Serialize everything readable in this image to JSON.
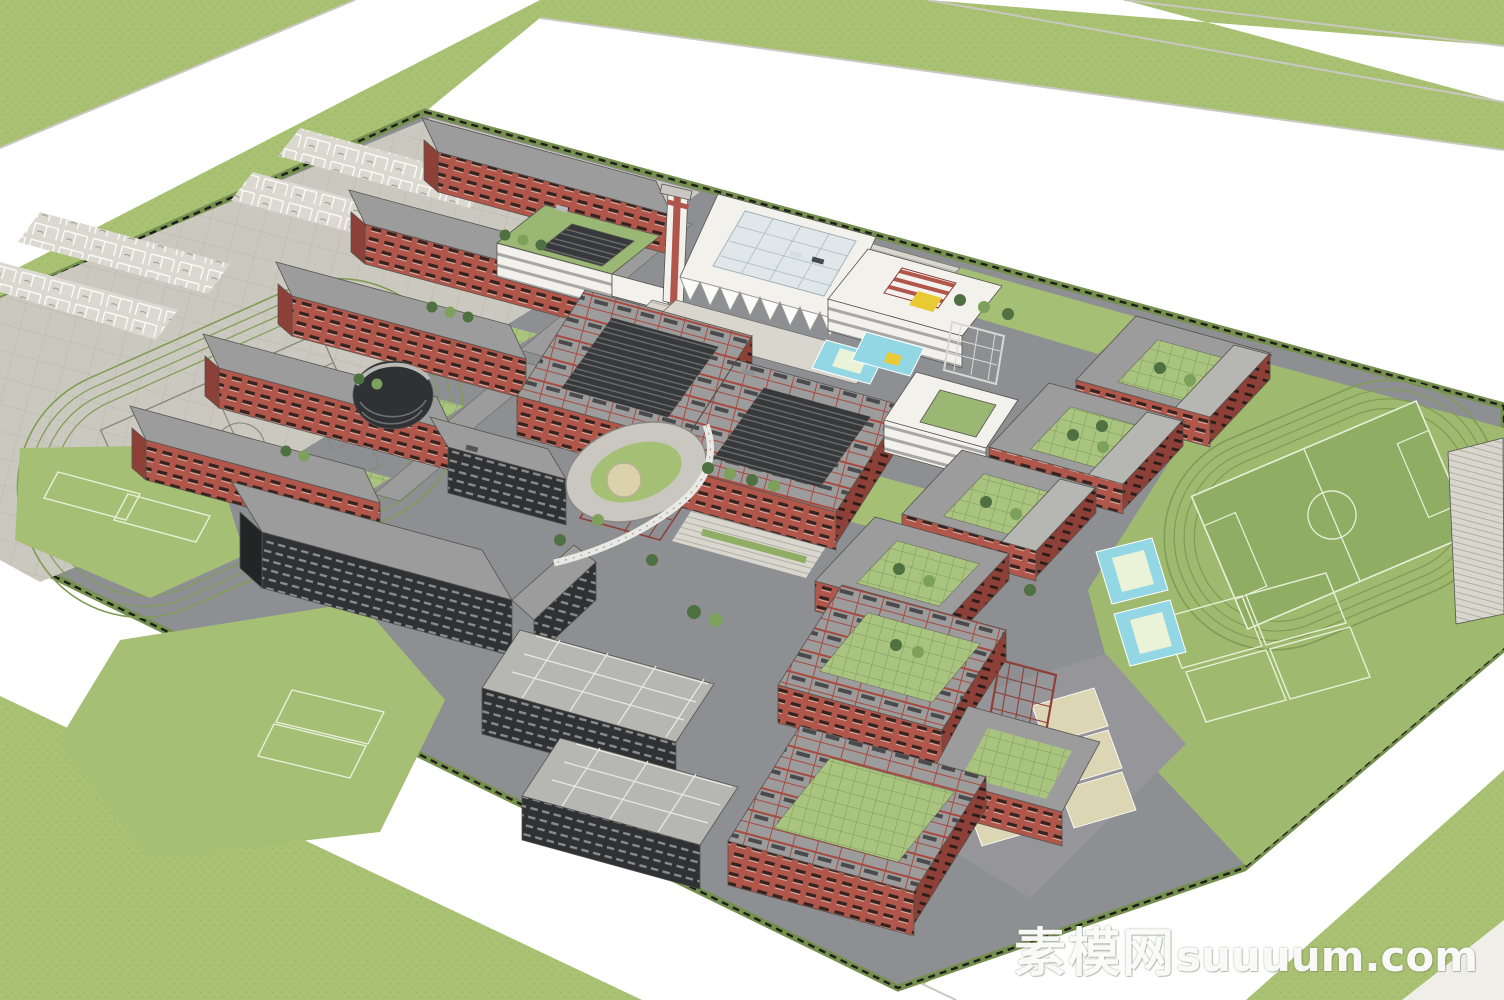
{
  "scene": {
    "type": "3d-campus-masterplan-render",
    "description": "Aerial axonometric SketchUp render of a university campus with red dormitory slabs, courtyard teaching buildings, white auditorium and library, clock tower, sports fields and surrounding roads"
  },
  "watermark": {
    "cn": "素模网",
    "en": "suuuum.com"
  },
  "colors": {
    "grass": "#a9c173",
    "grass_dark": "#9cb566",
    "road": "#ffffff",
    "road_edge": "#c9c8c0",
    "sidewalk": "#efeee9",
    "campus_asphalt": "#8e8f92",
    "pavement": "#cbc9bf",
    "pavement_light": "#dbd9cf",
    "pavement_line": "#96948a",
    "plaza": "#d8d6cd",
    "lawn": "#a5bf75",
    "sports_green": "#9fba6e",
    "field_green": "#8fae63",
    "field_line": "#e8efda",
    "track_line": "#7f9c55",
    "hedge": "#75904e",
    "fence": "#1d1d1b",
    "building_red": "#b0564a",
    "building_red_dark": "#8d4038",
    "window_dark": "#34231f",
    "roof_gray": "#9c9c9c",
    "roof_gray_light": "#b6b6b2",
    "dark_facade": "#303134",
    "dark_facade_hi": "#8a8b8d",
    "white_wall": "#f2f1ec",
    "white_band": "#a7a7a5",
    "green_roof": "#9ab873",
    "mesh_green": "#a9c47e",
    "mesh_line": "#7d985c",
    "court_cyan": "#93d7e4",
    "court_inner": "#eaf3d8",
    "tennis_tan": "#ddd6b4",
    "yellow": "#e9c934",
    "tree_green": "#4f7040",
    "tree_light": "#7da05b",
    "glass_blue": "#dfe7ea"
  }
}
